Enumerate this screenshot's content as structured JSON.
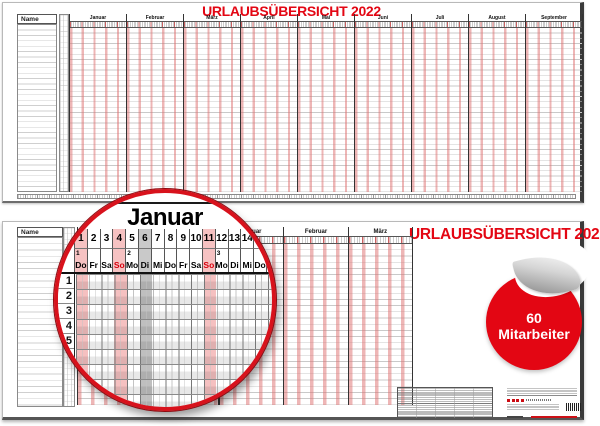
{
  "colors": {
    "accent_red": "#e30613",
    "stripe_pink": "#f6c2c2",
    "holiday_gray": "#c9c9c9",
    "sunday_text_red": "#d6000d"
  },
  "top_board": {
    "title": "URLAUBSÜBERSICHT 2022",
    "name_header": "Name",
    "months": [
      "Januar",
      "Februar",
      "März",
      "April",
      "Mai",
      "Juni",
      "Juli",
      "August",
      "September"
    ]
  },
  "bottom_board": {
    "title": "URLAUBSÜBERSICHT 2022",
    "name_header": "Name",
    "months": [
      "Januar",
      "Februar",
      "März"
    ]
  },
  "inset": {
    "month_title": "Januar",
    "day_numbers": [
      "1",
      "2",
      "3",
      "4",
      "5",
      "6",
      "7",
      "8",
      "9",
      "10",
      "11",
      "12",
      "13",
      "14",
      "15",
      "16"
    ],
    "weekdays": [
      "Do",
      "Fr",
      "Sa",
      "So",
      "Mo",
      "Di",
      "Mi",
      "Do",
      "Fr",
      "Sa",
      "So",
      "Mo",
      "Di",
      "Mi",
      "Do",
      "Fr",
      "Sa"
    ],
    "week_numbers": [
      {
        "label": "1",
        "day": 1
      },
      {
        "label": "2",
        "day": 5
      },
      {
        "label": "3",
        "day": 12
      }
    ],
    "pink_days": [
      1,
      4,
      11
    ],
    "gray_days": [
      6
    ],
    "row_numbers": [
      "1",
      "2",
      "3",
      "4",
      "5",
      "6"
    ]
  },
  "badge": {
    "value": "60",
    "label": "Mitarbeiter"
  }
}
